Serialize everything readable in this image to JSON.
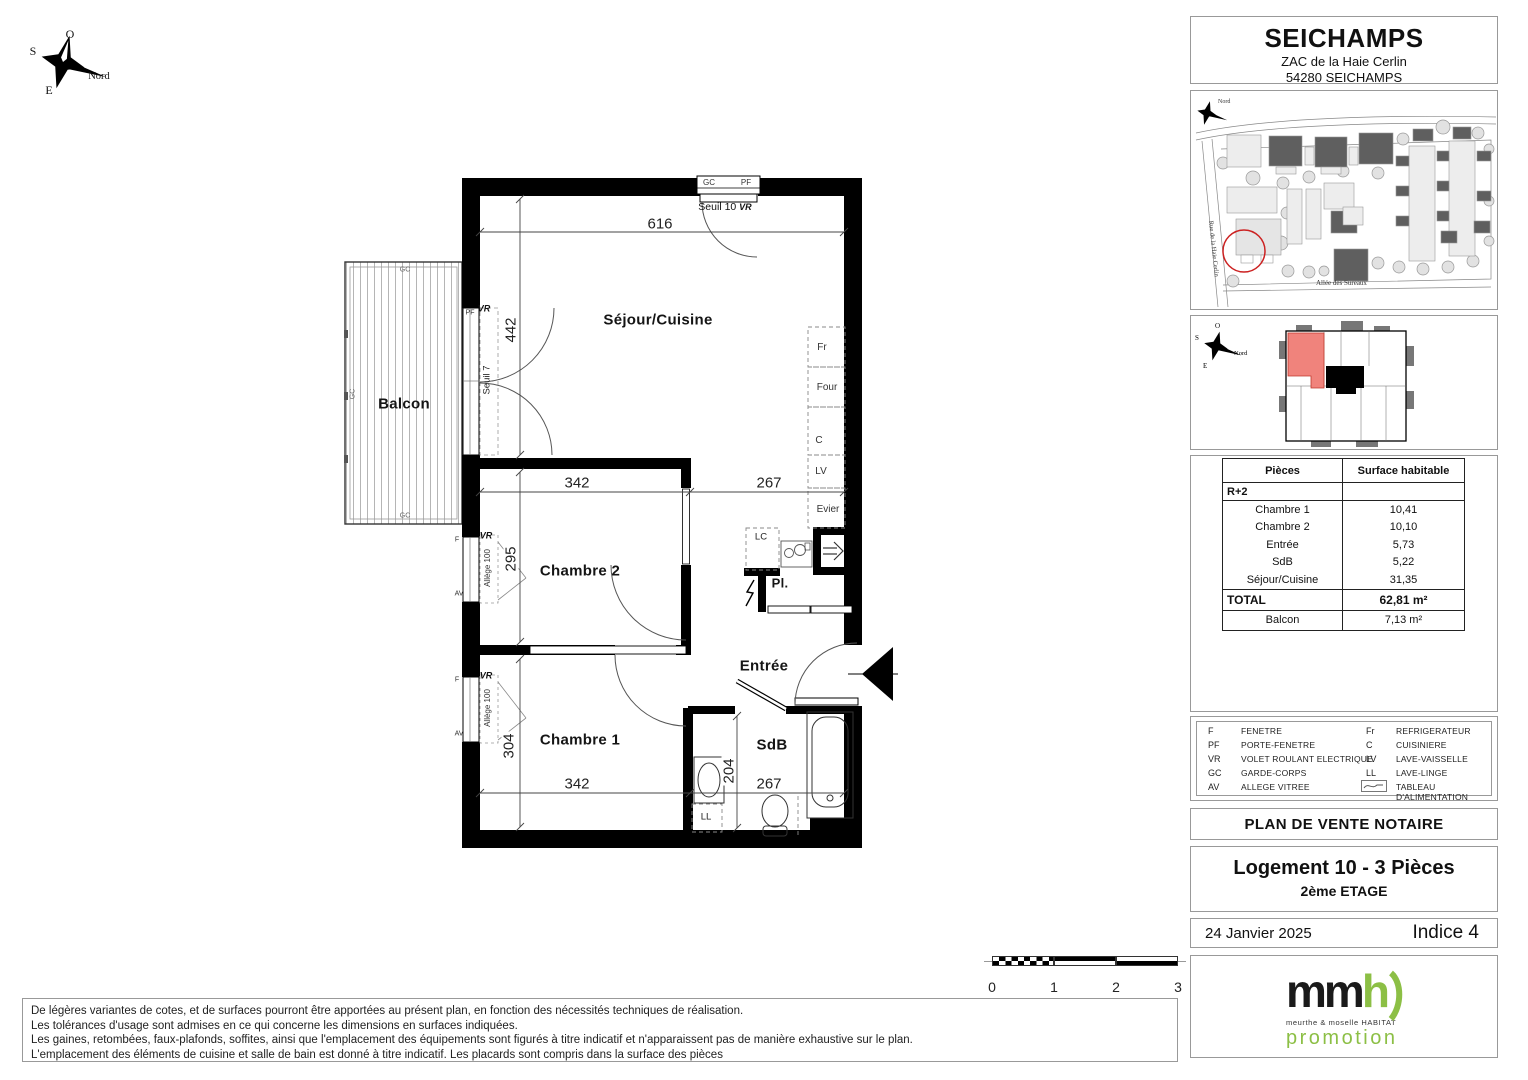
{
  "colors": {
    "wall": "#000000",
    "highlight_red": "#cc2222",
    "unit_fill": "#f0837c",
    "logo_green": "#8cbf45",
    "building_dark": "#5f5f5f"
  },
  "compass": {
    "o": "O",
    "s": "S",
    "e": "E",
    "nord": "Nord"
  },
  "header": {
    "title": "SEICHAMPS",
    "address1": "ZAC de la Haie Cerlin",
    "address2": "54280 SEICHAMPS"
  },
  "site_plan": {
    "street_left": "Rue de la Haie Cerlin",
    "street_bottom": "Allée des Sureaux",
    "north_label": "Nord"
  },
  "key_plan": {
    "o": "O",
    "s": "S",
    "e": "E",
    "nord": "Nord"
  },
  "plan": {
    "rooms": {
      "sejour": "Séjour/Cuisine",
      "balcon": "Balcon",
      "chambre2": "Chambre 2",
      "chambre1": "Chambre 1",
      "entree": "Entrée",
      "sdb": "SdB",
      "placard": "Pl."
    },
    "dims": {
      "top_width": "616",
      "sejour_height": "442",
      "ch2_width": "342",
      "hall_width": "267",
      "ch2_height": "295",
      "ch1_height": "304",
      "ch1_width": "342",
      "sdb_strip": "204",
      "sdb_width": "267"
    },
    "tags": {
      "gc": "GC",
      "pf": "PF",
      "vr": "VR",
      "f": "F",
      "av": "AV",
      "lc": "LC",
      "ll": "LL",
      "fr": "Fr",
      "four": "Four",
      "cuisiniere": "C",
      "lv": "LV",
      "evier": "Evier",
      "seuil10": "Seuil 10",
      "seuil7": "Seuil 7",
      "allege": "Allège 100"
    }
  },
  "table": {
    "header": [
      "Pièces",
      "Surface habitable"
    ],
    "floor_row": "R+2",
    "rows": [
      [
        "Chambre 1",
        "10,41"
      ],
      [
        "Chambre 2",
        "10,10"
      ],
      [
        "Entrée",
        "5,73"
      ],
      [
        "SdB",
        "5,22"
      ],
      [
        "Séjour/Cuisine",
        "31,35"
      ]
    ],
    "total": [
      "TOTAL",
      "62,81 m²"
    ],
    "balcony": [
      "Balcon",
      "7,13  m²"
    ]
  },
  "legend": {
    "left": [
      [
        "F",
        "FENETRE"
      ],
      [
        "PF",
        "PORTE-FENETRE"
      ],
      [
        "VR",
        "VOLET ROULANT ELECTRIQUE"
      ],
      [
        "GC",
        "GARDE-CORPS"
      ],
      [
        "AV",
        "ALLEGE VITREE"
      ]
    ],
    "right": [
      [
        "Fr",
        "REFRIGERATEUR"
      ],
      [
        "C",
        "CUISINIERE"
      ],
      [
        "LV",
        "LAVE-VAISSELLE"
      ],
      [
        "LL",
        "LAVE-LINGE"
      ],
      [
        "",
        "TABLEAU D'ALIMENTATION"
      ]
    ]
  },
  "title_block": {
    "doc_type": "PLAN DE VENTE NOTAIRE",
    "unit": "Logement 10  -  3 Pièces",
    "floor": "2ème ETAGE",
    "date": "24 Janvier 2025",
    "revision": "Indice 4"
  },
  "scale_bar": {
    "labels": [
      "0",
      "1",
      "2",
      "3"
    ]
  },
  "disclaimer": [
    "De légères variantes de cotes, et de surfaces pourront être apportées au présent plan, en fonction des nécessités techniques de réalisation.",
    "Les tolérances d'usage sont admises en ce qui concerne les dimensions en surfaces indiquées.",
    "Les gaines, retombées, faux-plafonds, soffites, ainsi que l'emplacement des équipements sont figurés à titre indicatif et n'apparaissent pas de manière exhaustive sur le plan.",
    "L'emplacement des éléments de cuisine et salle de bain est donné à titre indicatif. Les placards sont compris dans la surface des pièces"
  ],
  "logo": {
    "mm": "mm",
    "h": "h",
    "subtitle": "meurthe & moselle HABITAT",
    "promotion": "promotion"
  }
}
